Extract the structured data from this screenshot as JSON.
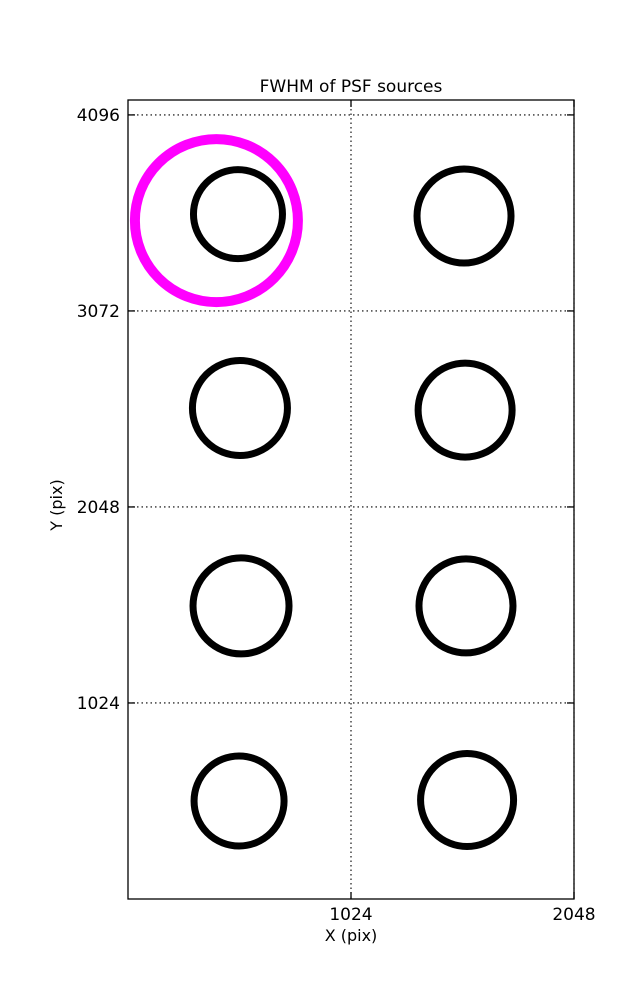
{
  "chart_data": {
    "type": "scatter",
    "title": "FWHM of PSF sources",
    "xlabel": "X (pix)",
    "ylabel": "Y (pix)",
    "xlim": [
      0,
      2048
    ],
    "ylim": [
      0,
      4174
    ],
    "xticks": [
      1024,
      2048
    ],
    "yticks": [
      1024,
      2048,
      3072,
      4096
    ],
    "grid": {
      "visible": true,
      "style": "dotted",
      "color": "#000000"
    },
    "axes_color": "#000000",
    "background_color": "#ffffff",
    "legend": "none",
    "series": [
      {
        "name": "highlighted-source",
        "marker": "circle-outline",
        "color": "#ff00ff",
        "stroke_px": 10,
        "points": [
          {
            "x": 406,
            "y": 3544,
            "r_px": 81.5
          }
        ]
      },
      {
        "name": "psf-sources",
        "marker": "circle-outline",
        "color": "#000000",
        "stroke_px": 7,
        "points": [
          {
            "x": 505,
            "y": 3578,
            "r_px": 44.5
          },
          {
            "x": 1543,
            "y": 3568,
            "r_px": 47
          },
          {
            "x": 514,
            "y": 2565,
            "r_px": 47.5
          },
          {
            "x": 1548,
            "y": 2554,
            "r_px": 47
          },
          {
            "x": 519,
            "y": 1531,
            "r_px": 48
          },
          {
            "x": 1552,
            "y": 1531,
            "r_px": 47
          },
          {
            "x": 510,
            "y": 512,
            "r_px": 45
          },
          {
            "x": 1557,
            "y": 517,
            "r_px": 46.5
          }
        ]
      }
    ]
  }
}
